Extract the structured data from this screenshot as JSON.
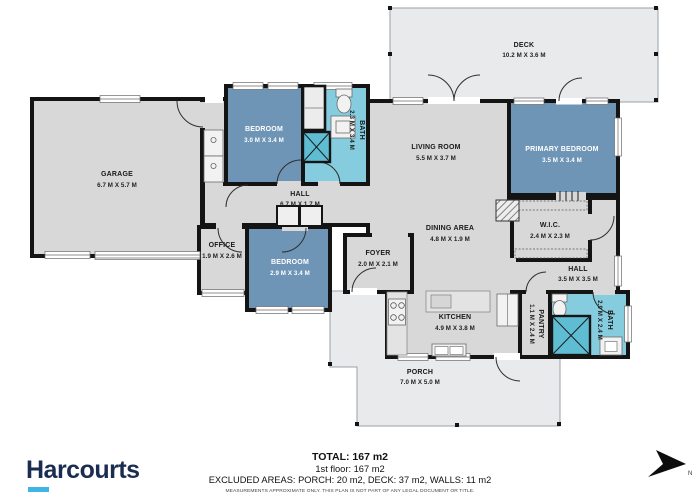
{
  "branding": {
    "logo": "Harcourts"
  },
  "plan": {
    "rooms": {
      "deck": {
        "name": "DECK",
        "dims": "10.2 M X 3.6 M"
      },
      "garage": {
        "name": "GARAGE",
        "dims": "6.7 M X 5.7 M"
      },
      "bedroom_top": {
        "name": "BEDROOM",
        "dims": "3.0 M X 3.4 M"
      },
      "bath_top": {
        "name": "BATH",
        "dims": "2.3 M X 3.4 M"
      },
      "living": {
        "name": "LIVING ROOM",
        "dims": "5.5 M X 3.7 M"
      },
      "primary": {
        "name": "PRIMARY BEDROOM",
        "dims": "3.5 M X 3.4 M"
      },
      "hall_top": {
        "name": "HALL",
        "dims": "6.7 M X 1.7 M"
      },
      "office": {
        "name": "OFFICE",
        "dims": "1.9 M X 2.6 M"
      },
      "bedroom_mid": {
        "name": "BEDROOM",
        "dims": "2.9 M X 3.4 M"
      },
      "foyer": {
        "name": "FOYER",
        "dims": "2.0 M X 2.1 M"
      },
      "dining": {
        "name": "DINING AREA",
        "dims": "4.8 M X 1.9 M"
      },
      "wic": {
        "name": "W.I.C.",
        "dims": "2.4 M X 2.3 M"
      },
      "hall_right": {
        "name": "HALL",
        "dims": "3.5 M X 3.5 M"
      },
      "kitchen": {
        "name": "KITCHEN",
        "dims": "4.9 M X 3.8 M"
      },
      "pantry": {
        "name": "PANTRY",
        "dims": "1.1 M X 2.4 M"
      },
      "bath_right": {
        "name": "BATH",
        "dims": "2.9 M X 2.4 M"
      },
      "porch": {
        "name": "PORCH",
        "dims": "7.0 M X 5.0 M"
      }
    }
  },
  "summary": {
    "total": "TOTAL: 167 m2",
    "floor": "1st floor: 167 m2",
    "excluded": "EXCLUDED AREAS: PORCH: 20 m2, DECK: 37 m2, WALLS: 11 m2",
    "disclaimer": "MEASUREMENTS APPROXIMATE ONLY. THIS PLAN IS NOT PART OF ANY LEGAL DOCUMENT OR TITLE."
  },
  "compass": {
    "label": "N"
  },
  "colors": {
    "bedroom_fill": "#6e94b6",
    "bath_fill": "#85ccde",
    "floor_fill": "#d8d8d8",
    "outdoor_fill": "#e9eaec",
    "wall": "#141414",
    "brand_navy": "#1a2c50",
    "brand_cyan": "#41b4e6"
  }
}
